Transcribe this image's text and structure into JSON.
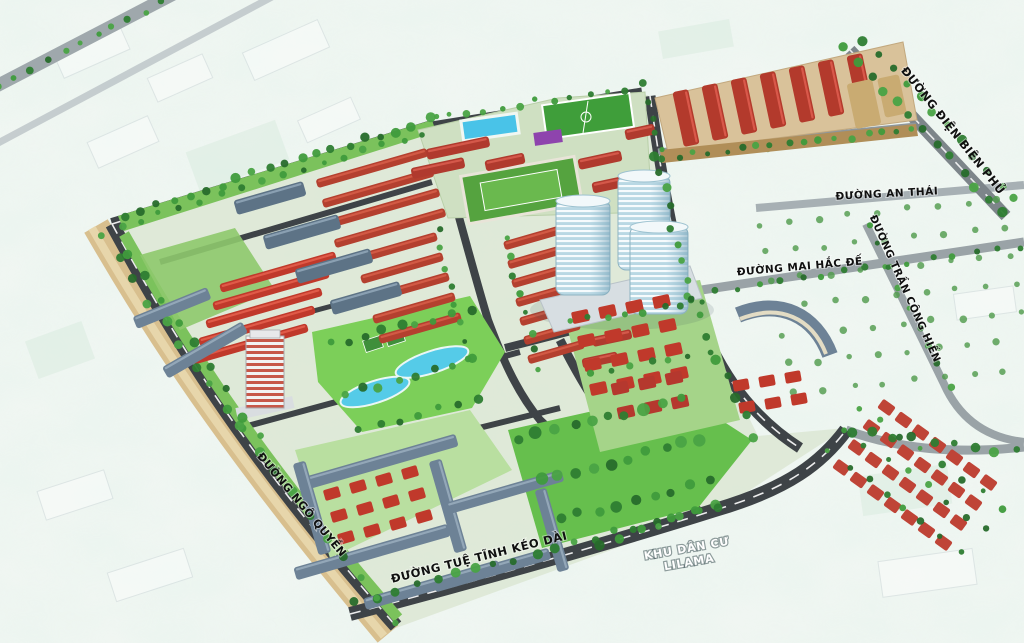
{
  "scene": {
    "type": "masterplan-aerial-render",
    "labels": {
      "streets": [
        {
          "id": "duong-dien-bien-phu",
          "text": "ĐƯỜNG ĐIỆN BIÊN PHỦ"
        },
        {
          "id": "duong-an-thai",
          "text": "ĐƯỜNG AN THÁI"
        },
        {
          "id": "duong-tran-cong-hien",
          "text": "ĐƯỜNG TRẦN CÔNG HIẾN"
        },
        {
          "id": "duong-mai-hac-de",
          "text": "ĐƯỜNG MAI HẮC ĐẾ"
        },
        {
          "id": "duong-ngo-quyen",
          "text": "ĐƯỜNG NGÔ QUYỀN"
        },
        {
          "id": "duong-tue-tinh",
          "text": "ĐƯỜNG TUỆ TĨNH KÉO DÀI"
        }
      ],
      "area": {
        "line1": "KHU DÂN CƯ",
        "line2": "LILAMA"
      }
    },
    "palette": {
      "background": "#eef4f0",
      "red_roof": "#b5392c",
      "villa_red": "#c0392b",
      "blue_grey_roof": "#6d8296",
      "embankment_tan": "#d8bf8e",
      "factory_ground_tan": "#d9c29a",
      "road_dark": "#3e4347",
      "road_light": "#a7b0b4",
      "park_green": "#6cc44f",
      "lawn_green": "#7bc25c",
      "pool_blue": "#49c3e8",
      "tower_glass": "#b9d8e4",
      "purple_building": "#8e44ad"
    }
  }
}
